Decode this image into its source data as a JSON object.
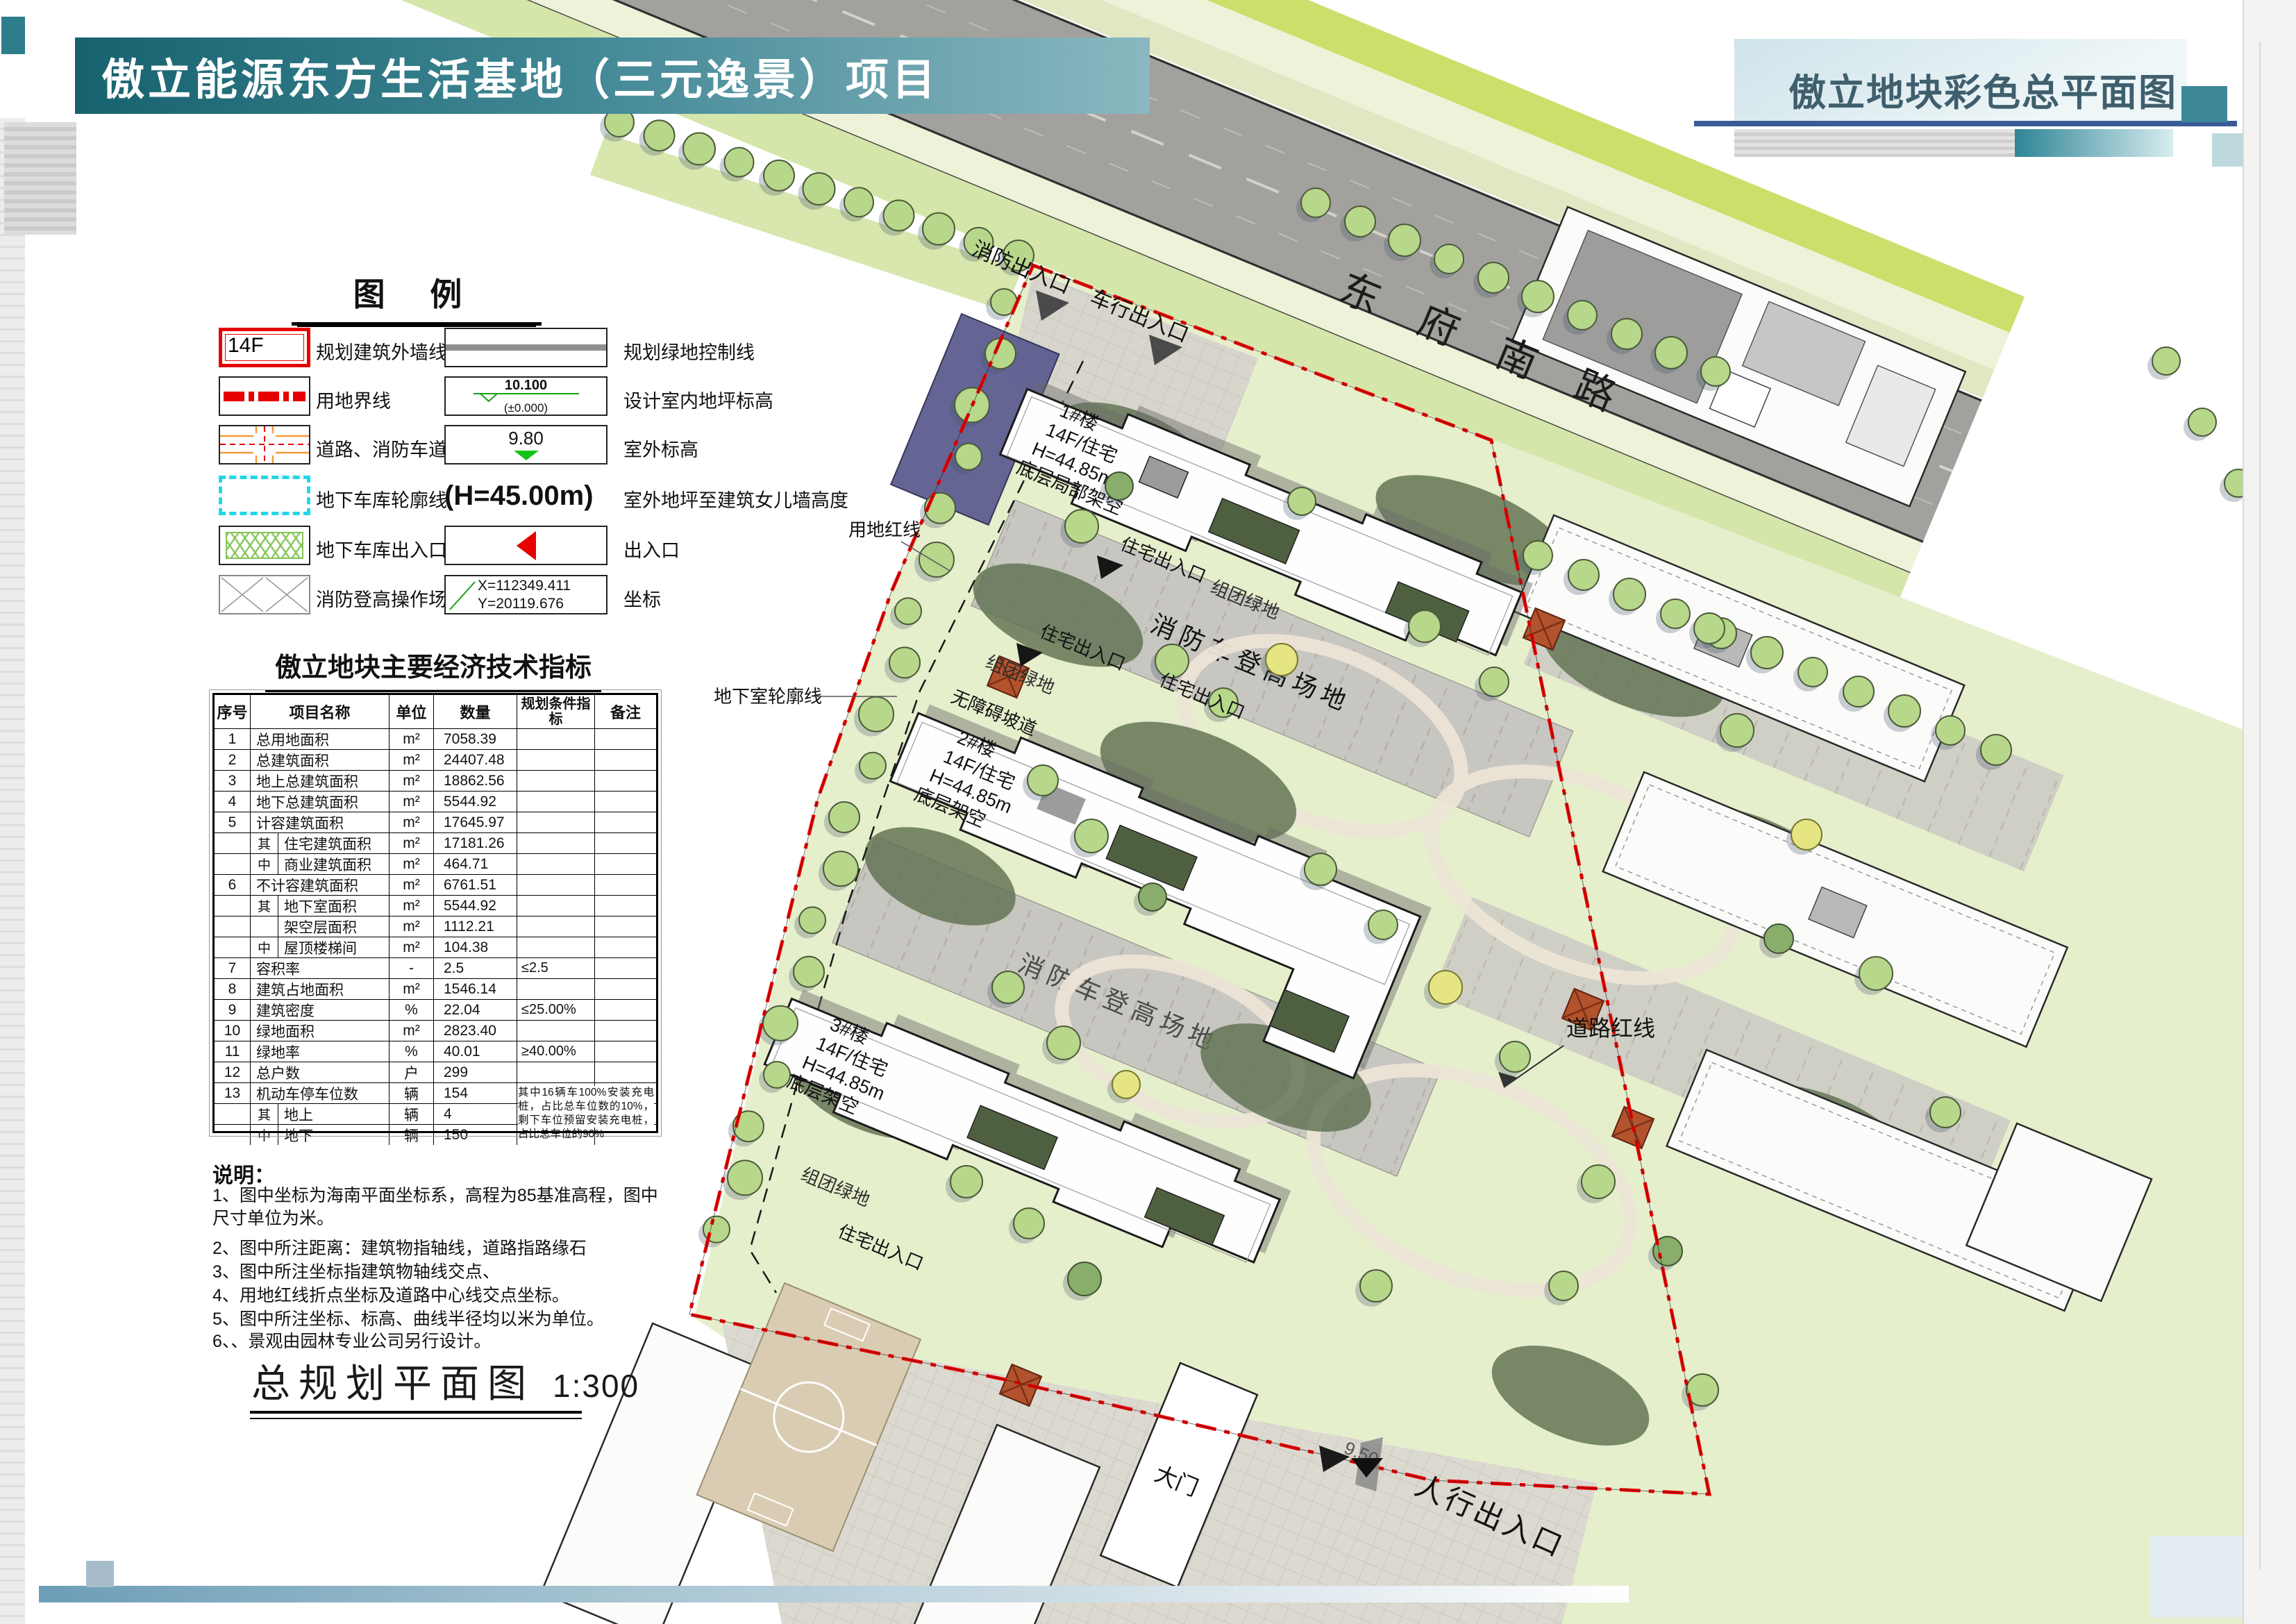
{
  "header": {
    "title": "傲立能源东方生活基地（三元逸景）项目",
    "subtitle_right": "傲立地块彩色总平面图"
  },
  "legend": {
    "title": "图  例",
    "items_left": [
      {
        "symbol": "building-outline",
        "symbol_text": "14F",
        "label": "规划建筑外墙线及层数"
      },
      {
        "symbol": "land-boundary",
        "label": "用地界线"
      },
      {
        "symbol": "road-firelane",
        "label": "道路、消防车道"
      },
      {
        "symbol": "garage-outline",
        "label": "地下车库轮廓线"
      },
      {
        "symbol": "garage-entrance",
        "label": "地下车库出入口"
      },
      {
        "symbol": "fire-operation-field",
        "label": "消防登高操作场地"
      }
    ],
    "items_right": [
      {
        "symbol": "green-control-line",
        "label": "规划绿地控制线"
      },
      {
        "symbol": "indoor-level",
        "value": "10.100",
        "value2": "(±0.000)",
        "label": "设计室内地坪标高"
      },
      {
        "symbol": "outdoor-level",
        "value": "9.80",
        "label": "室外标高"
      },
      {
        "symbol": "height-text",
        "value": "(H=45.00m)",
        "label": "室外地坪至建筑女儿墙高度"
      },
      {
        "symbol": "entrance-arrow",
        "label": "出入口"
      },
      {
        "symbol": "coordinate",
        "value": "X=112349.411",
        "value2": "Y=20119.676",
        "label": "坐标"
      }
    ]
  },
  "table": {
    "title": "傲立地块主要经济技术指标",
    "headers": [
      "序号",
      "项目名称",
      "单位",
      "数量",
      "规划条件指标",
      "备注"
    ],
    "rows": [
      {
        "no": "1",
        "name": "总用地面积",
        "unit": "m²",
        "qty": "7058.39",
        "cond": "",
        "note": ""
      },
      {
        "no": "2",
        "name": "总建筑面积",
        "unit": "m²",
        "qty": "24407.48",
        "cond": "",
        "note": ""
      },
      {
        "no": "3",
        "name": "地上总建筑面积",
        "unit": "m²",
        "qty": "18862.56",
        "cond": "",
        "note": ""
      },
      {
        "no": "4",
        "name": "地下总建筑面积",
        "unit": "m²",
        "qty": "5544.92",
        "cond": "",
        "note": ""
      },
      {
        "no": "5",
        "name": "计容建筑面积",
        "unit": "m²",
        "qty": "17645.97",
        "cond": "",
        "note": ""
      },
      {
        "no": "",
        "group": "其",
        "name": "住宅建筑面积",
        "unit": "m²",
        "qty": "17181.26",
        "cond": "",
        "note": ""
      },
      {
        "no": "",
        "group": "中",
        "name": "商业建筑面积",
        "unit": "m²",
        "qty": "464.71",
        "cond": "",
        "note": ""
      },
      {
        "no": "6",
        "name": "不计容建筑面积",
        "unit": "m²",
        "qty": "6761.51",
        "cond": "",
        "note": ""
      },
      {
        "no": "",
        "group": "其",
        "name": "地下室面积",
        "unit": "m²",
        "qty": "5544.92",
        "cond": "",
        "note": ""
      },
      {
        "no": "",
        "group": "",
        "name": "架空层面积",
        "unit": "m²",
        "qty": "1112.21",
        "cond": "",
        "note": ""
      },
      {
        "no": "",
        "group": "中",
        "name": "屋顶楼梯间",
        "unit": "m²",
        "qty": "104.38",
        "cond": "",
        "note": ""
      },
      {
        "no": "7",
        "name": "容积率",
        "unit": "-",
        "qty": "2.5",
        "cond": "≤2.5",
        "note": ""
      },
      {
        "no": "8",
        "name": "建筑占地面积",
        "unit": "m²",
        "qty": "1546.14",
        "cond": "",
        "note": ""
      },
      {
        "no": "9",
        "name": "建筑密度",
        "unit": "%",
        "qty": "22.04",
        "cond": "≤25.00%",
        "note": ""
      },
      {
        "no": "10",
        "name": "绿地面积",
        "unit": "m²",
        "qty": "2823.40",
        "cond": "",
        "note": ""
      },
      {
        "no": "11",
        "name": "绿地率",
        "unit": "%",
        "qty": "40.01",
        "cond": "≥40.00%",
        "note": ""
      },
      {
        "no": "12",
        "name": "总户数",
        "unit": "户",
        "qty": "299",
        "cond": "",
        "note": ""
      },
      {
        "no": "13",
        "name": "机动车停车位数",
        "unit": "辆",
        "qty": "154",
        "cond": "≥154辆",
        "note": ""
      },
      {
        "no": "",
        "group": "其",
        "name": "地上",
        "unit": "辆",
        "qty": "4",
        "cond": "",
        "note": ""
      },
      {
        "no": "",
        "group": "中",
        "name": "地下",
        "unit": "辆",
        "qty": "150",
        "cond": "",
        "note": ""
      }
    ],
    "parking_note": "其中16辆车100%安装充电桩，占比总车位数的10%，剩下车位预留安装充电桩，占比总车位的90%"
  },
  "notes": {
    "title": "说明：",
    "items": [
      "1、图中坐标为海南平面坐标系，高程为85基准高程，图中尺寸单位为米。",
      "2、图中所注距离：建筑物指轴线，道路指路缘石",
      "3、图中所注坐标指建筑物轴线交点、",
      "4、用地红线折点坐标及道路中心线交点坐标。",
      "5、图中所注坐标、标高、曲线半径均以米为单位。",
      "6、、景观由园林专业公司另行设计。"
    ]
  },
  "drawing": {
    "title": "总规划平面图",
    "scale": "1:300"
  },
  "plan": {
    "road_name": "东府南路",
    "buildings": [
      {
        "id": "1#楼",
        "use": "14F/住宅",
        "height": "H=44.85m",
        "note": "底层局部架空"
      },
      {
        "id": "2#楼",
        "use": "14F/住宅",
        "height": "H=44.85m",
        "note": "底层架空"
      },
      {
        "id": "3#楼",
        "use": "14F/住宅",
        "height": "H=44.85m",
        "note": "底层架空"
      }
    ],
    "labels": {
      "fire_lane": "消防车登高场地",
      "residential_entrance": "住宅出入口",
      "cluster_green": "组团绿地",
      "ramp": "无障碍坡道",
      "basement_outline": "地下室轮廓线",
      "site_red_line": "用地红线",
      "road_red_line": "道路红线",
      "gate": "大门",
      "pedestrian_entrance": "人行出入口",
      "fire_entrance": "消防出入口",
      "vehicle_entrance": "车行出入口",
      "elevation_950": "9.50"
    }
  }
}
